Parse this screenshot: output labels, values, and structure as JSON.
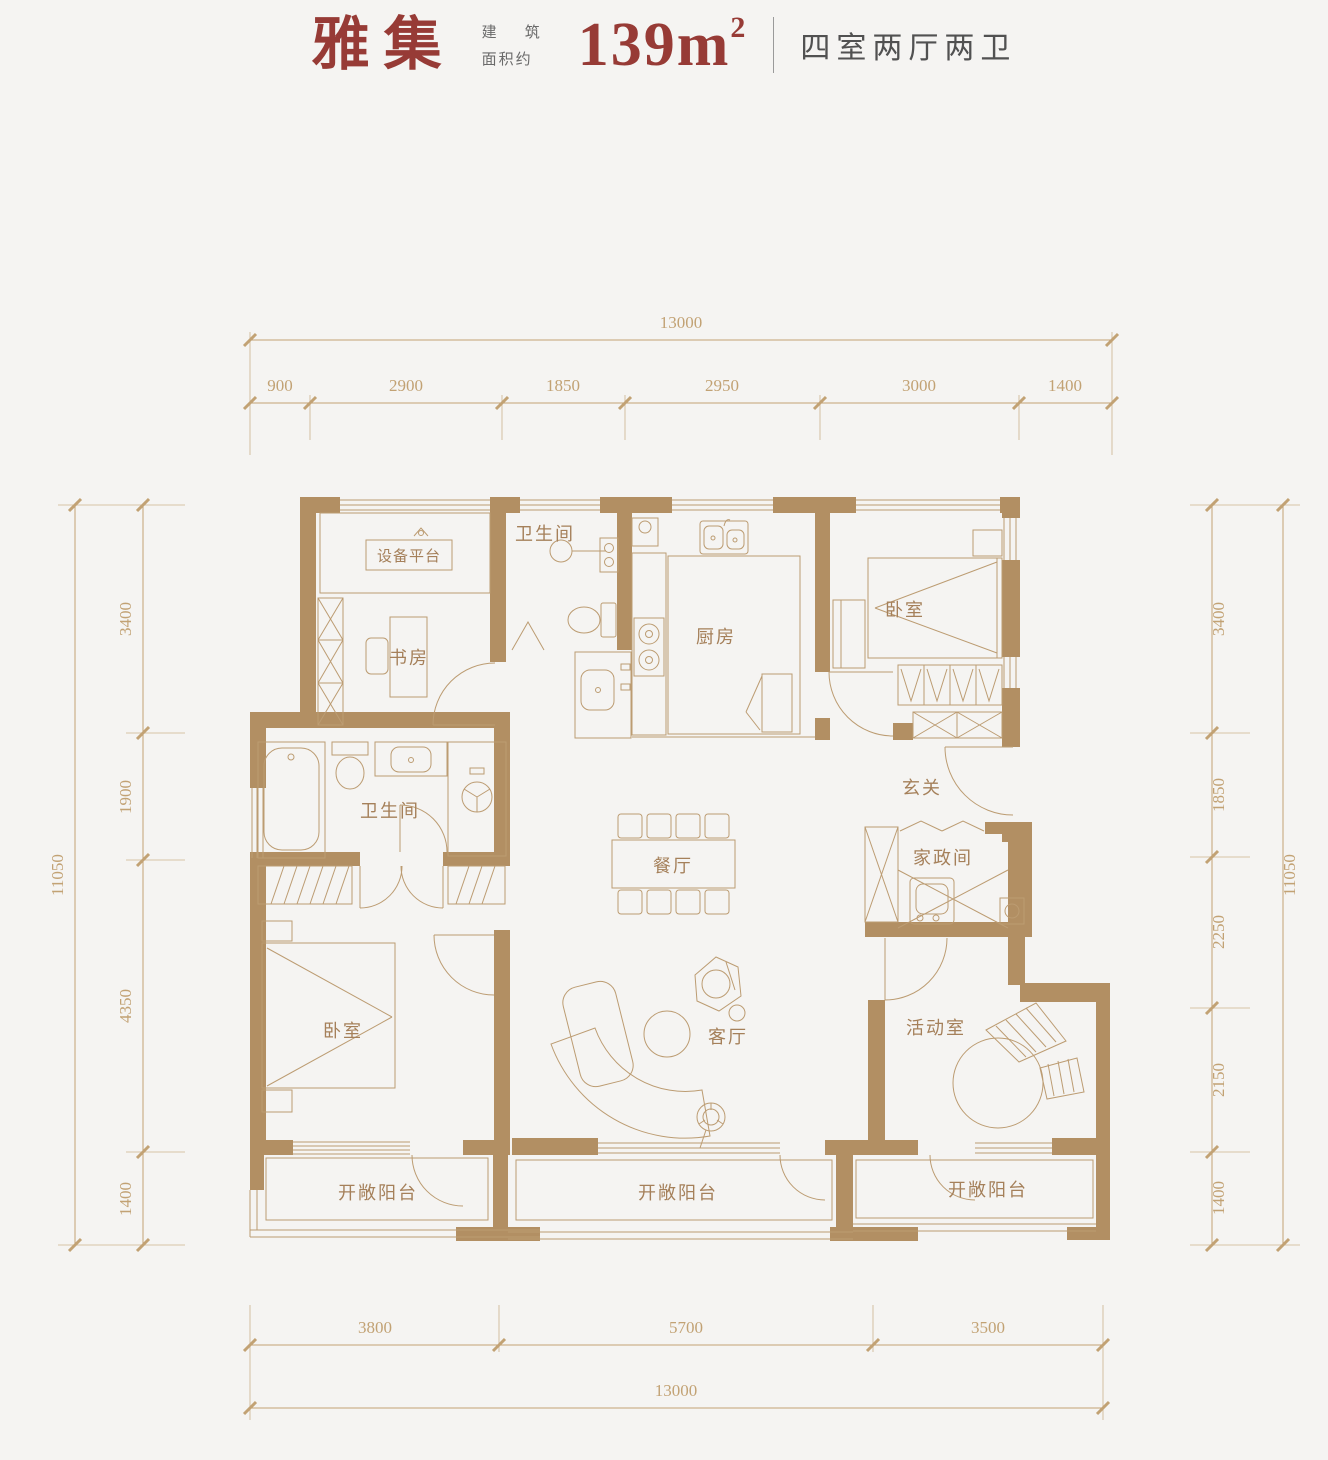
{
  "header": {
    "title": "雅集",
    "area_label_line1": "建 筑",
    "area_label_line2": "面积约",
    "area_value": "139m",
    "area_sup": "2",
    "unit_layout": "四室两厅两卫"
  },
  "rooms": {
    "equipment_platform": "设备平台",
    "bath_top": "卫生间",
    "kitchen": "厨房",
    "bedroom_top": "卧室",
    "study": "书房",
    "bath_main": "卫生间",
    "entry": "玄关",
    "utility": "家政间",
    "dining": "餐厅",
    "bedroom_main": "卧室",
    "living": "客厅",
    "activity": "活动室",
    "balcony_left": "开敞阳台",
    "balcony_middle": "开敞阳台",
    "balcony_right": "开敞阳台"
  },
  "dimensions": {
    "top": {
      "total": "13000",
      "segments": [
        "900",
        "2900",
        "1850",
        "2950",
        "3000",
        "1400"
      ]
    },
    "bottom": {
      "total": "13000",
      "segments": [
        "3800",
        "5700",
        "3500"
      ]
    },
    "left": {
      "total": "11050",
      "segments": [
        "3400",
        "1900",
        "4350",
        "1400"
      ]
    },
    "right": {
      "total": "11050",
      "segments": [
        "3400",
        "1850",
        "2250",
        "2150",
        "1400"
      ]
    }
  },
  "colors": {
    "background": "#f5f4f2",
    "wall": "#b28f63",
    "line": "#bc9c72",
    "label": "#a5805a",
    "dim": "#c2a274",
    "accent": "#973b36",
    "muted": "#5f5f5f"
  }
}
